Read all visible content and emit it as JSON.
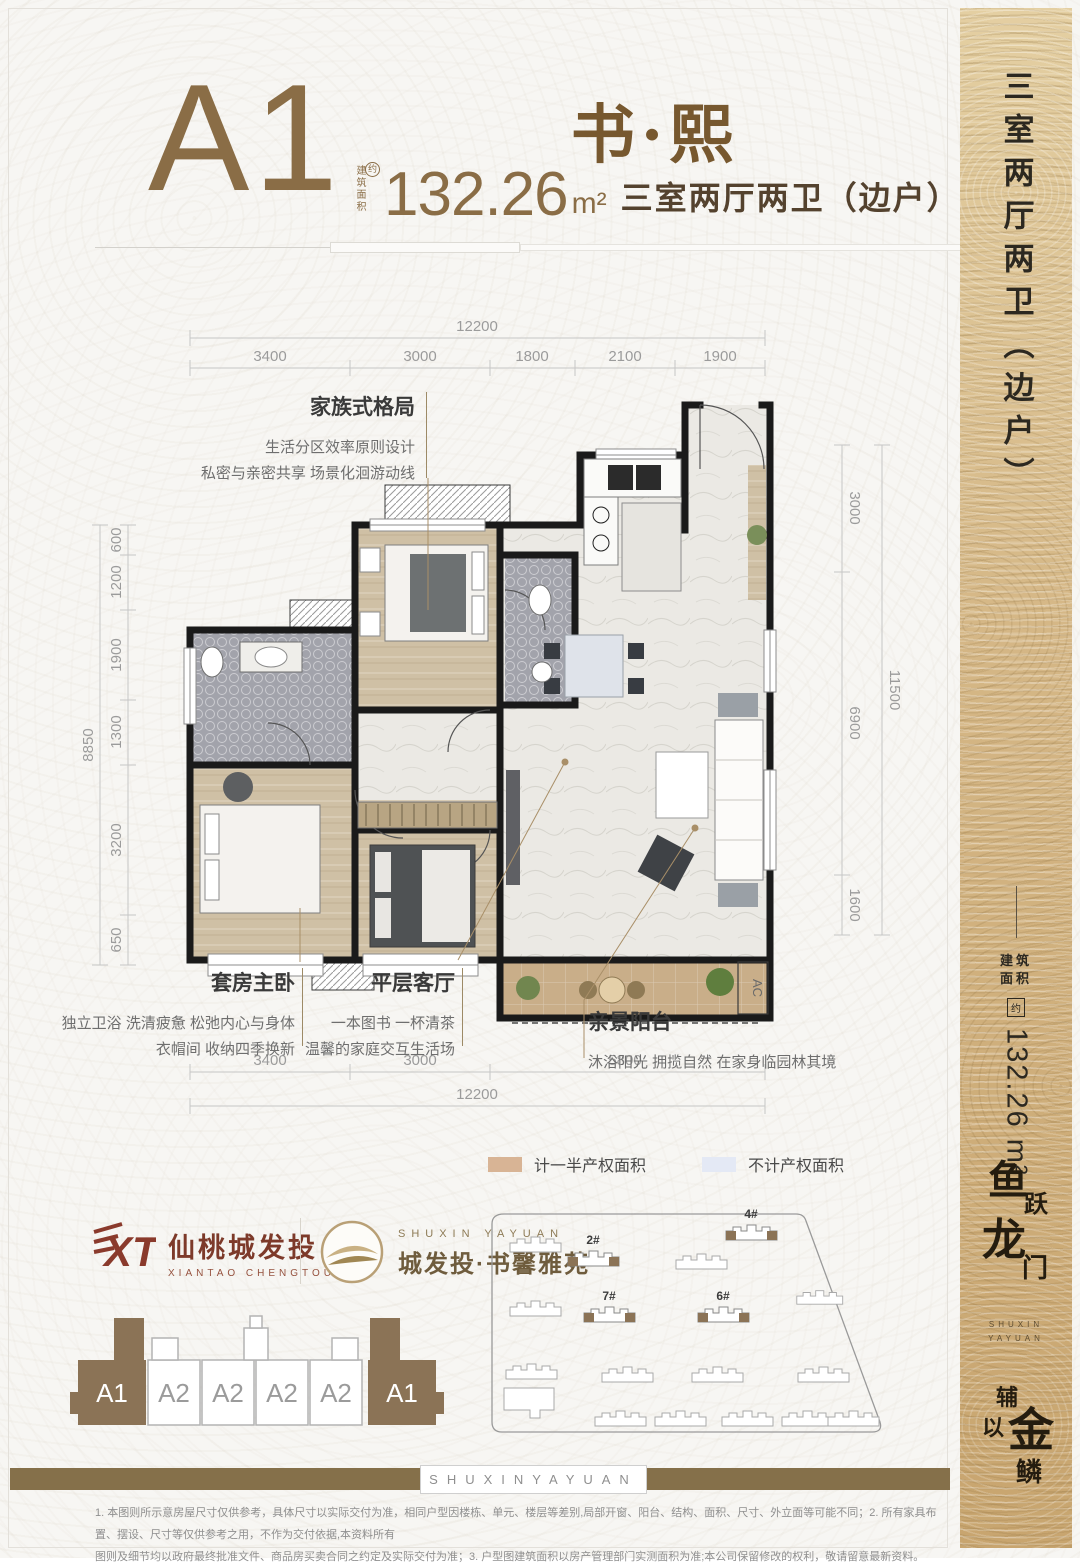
{
  "header": {
    "unit_code": "A1",
    "name": "书·熙",
    "area_label": "建筑面积",
    "area_approx": "约",
    "area_value": "132.26",
    "area_unit": "m²",
    "layout_text": "三室两厅两卫（边户）"
  },
  "sidebar": {
    "title": "三室两厅两卫（边户）",
    "area_label_line1": "建筑",
    "area_label_line2": "面积",
    "area_approx": "约",
    "area_value": "132.26 m²",
    "slogan1_chars": [
      "鱼",
      "跃",
      "龙",
      "门"
    ],
    "slogan2_chars": [
      "辅",
      "以",
      "金",
      "鳞"
    ],
    "slogan_en_line1": "SHUXIN",
    "slogan_en_line2": "YAYUAN"
  },
  "plan": {
    "dims_top_total": "12200",
    "dims_top": [
      "3400",
      "3000",
      "1800",
      "2100",
      "1900"
    ],
    "dims_left_total": "8850",
    "dims_left": [
      "600",
      "1200",
      "1900",
      "1300",
      "3200",
      "650"
    ],
    "dims_right_total": "11500",
    "dims_right": [
      "3000",
      "6900",
      "1600"
    ],
    "dims_bottom": [
      "3400",
      "3000",
      "5800"
    ],
    "dims_bottom_total": "12200",
    "ac_label": "AC"
  },
  "annotations": {
    "family": {
      "title": "家族式格局",
      "line1": "生活分区效率原则设计",
      "line2": "私密与亲密共享 场景化洄游动线"
    },
    "master": {
      "title": "套房主卧",
      "line1": "独立卫浴 洗清疲惫 松弛内心与身体",
      "line2": "衣帽间 收纳四季换新"
    },
    "living": {
      "title": "平层客厅",
      "line1": "一本图书 一杯清茶",
      "line2": "温馨的家庭交互生活场"
    },
    "balcony": {
      "title": "亲景阳台",
      "line1": "沐浴阳光 拥揽自然 在家身临园林其境"
    }
  },
  "legend": {
    "half_label": "计一半产权面积",
    "half_color": "#d8b495",
    "none_label": "不计产权面积",
    "none_color": "#e4e9f5"
  },
  "logos": {
    "dev_mark": "XT",
    "dev_name": "仙桃城发投",
    "dev_sub": "XIANTAO CHENGTOU",
    "project_en": "SHUXIN YAYUAN",
    "project_name": "城发投·书馨雅苑"
  },
  "strip": {
    "units": [
      "A1",
      "A2",
      "A2",
      "A2",
      "A2",
      "A1"
    ]
  },
  "siteplan": {
    "labels": [
      "2#",
      "4#",
      "7#",
      "6#"
    ]
  },
  "footer": {
    "bar_text": "SHUXINYAYUAN",
    "disclaimer_line1": "1. 本图则所示意房屋尺寸仅供参考，具体尺寸以实际交付为准，相同户型因楼栋、单元、楼层等差别,局部开窗、阳台、结构、面积、尺寸、外立面等可能不同；2. 所有家具布置、摆设、尺寸等仅供参考之用，不作为交付依据,本资料所有",
    "disclaimer_line2": "图则及细节均以政府最终批准文件、商品房买卖合同之约定及实际交付为准；3. 户型图建筑面积以房产管理部门实测面积为准;本公司保留修改的权利，敬请留意最新资料。"
  },
  "colors": {
    "accent_brown": "#8a6d46",
    "wall_black": "#1a1a1a",
    "sidebar_tan": "#d4b584",
    "bar_olive": "#85704a",
    "logo_red": "#8a3a2c"
  }
}
